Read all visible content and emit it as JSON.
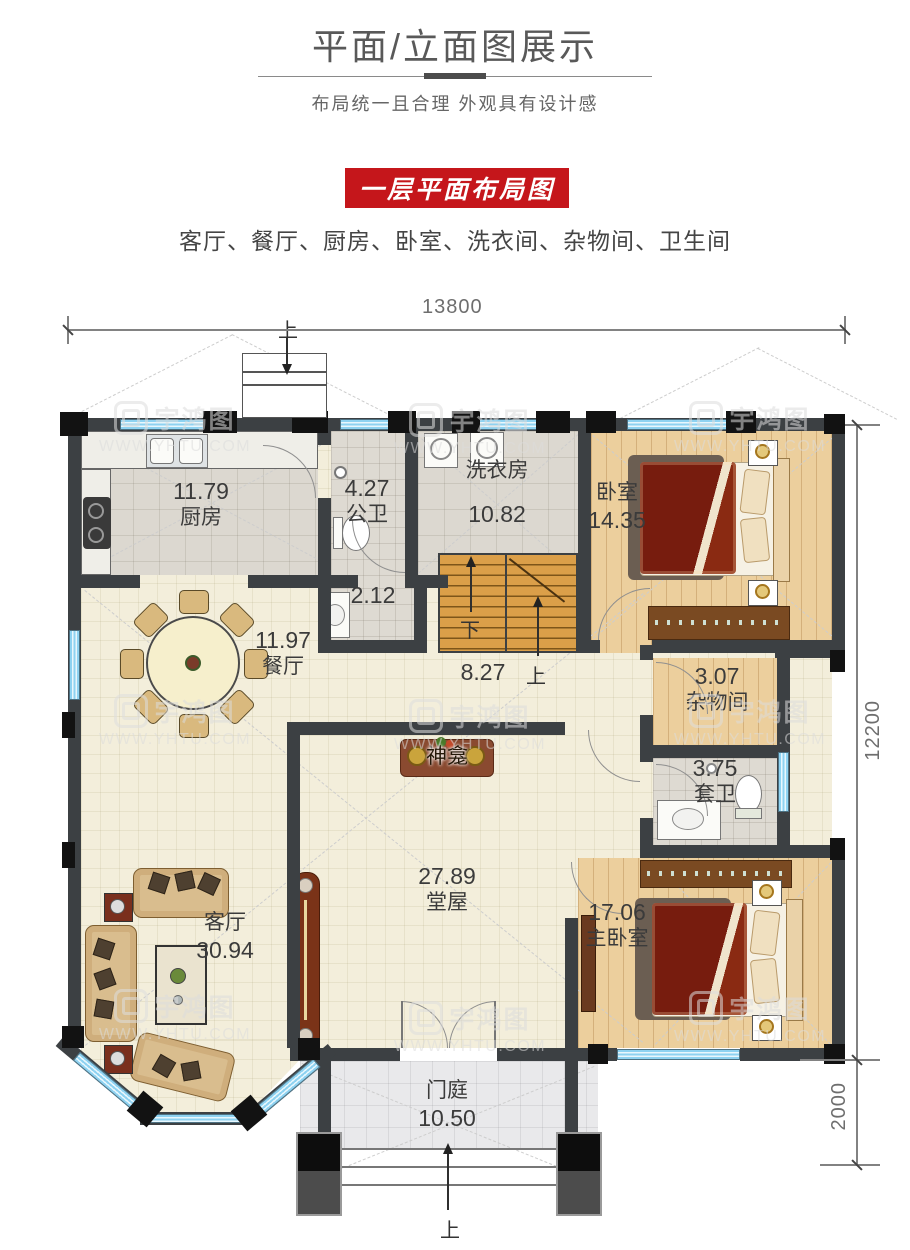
{
  "header": {
    "title": "平面/立面图展示",
    "subtitle": "布局统一且合理  外观具有设计感"
  },
  "banner": {
    "label": "一层平面布局图",
    "bg_color": "#c5161b"
  },
  "summary": {
    "rooms_line": "客厅、餐厅、厨房、卧室、洗衣间、杂物间、卫生间"
  },
  "dims": {
    "width_top": "13800",
    "height_right": "12200",
    "porch_depth": "2000"
  },
  "rooms": {
    "kitchen": {
      "area": "11.79",
      "name": "厨房"
    },
    "public_bath": {
      "area": "4.27",
      "name": "公卫"
    },
    "wash_nook": {
      "area": "2.12"
    },
    "laundry": {
      "name": "洗衣房",
      "area": "10.82"
    },
    "bedroom": {
      "name": "卧室",
      "area": "14.35"
    },
    "dining": {
      "area": "11.97",
      "name": "餐厅"
    },
    "stair_hall": {
      "area": "8.27"
    },
    "storage": {
      "area": "3.07",
      "name": "杂物间"
    },
    "ensuite": {
      "area": "3.75",
      "name": "套卫"
    },
    "main_hall": {
      "area": "27.89",
      "name": "堂屋"
    },
    "living": {
      "name": "客厅",
      "area": "30.94"
    },
    "master": {
      "area": "17.06",
      "name": "主卧室"
    },
    "porch": {
      "name": "门庭",
      "area": "10.50"
    }
  },
  "labels": {
    "shrine": "神龛",
    "up": "上",
    "down": "下"
  },
  "watermark": {
    "brand": "宇鸿图",
    "url": "WWW.YHTU.COM"
  }
}
